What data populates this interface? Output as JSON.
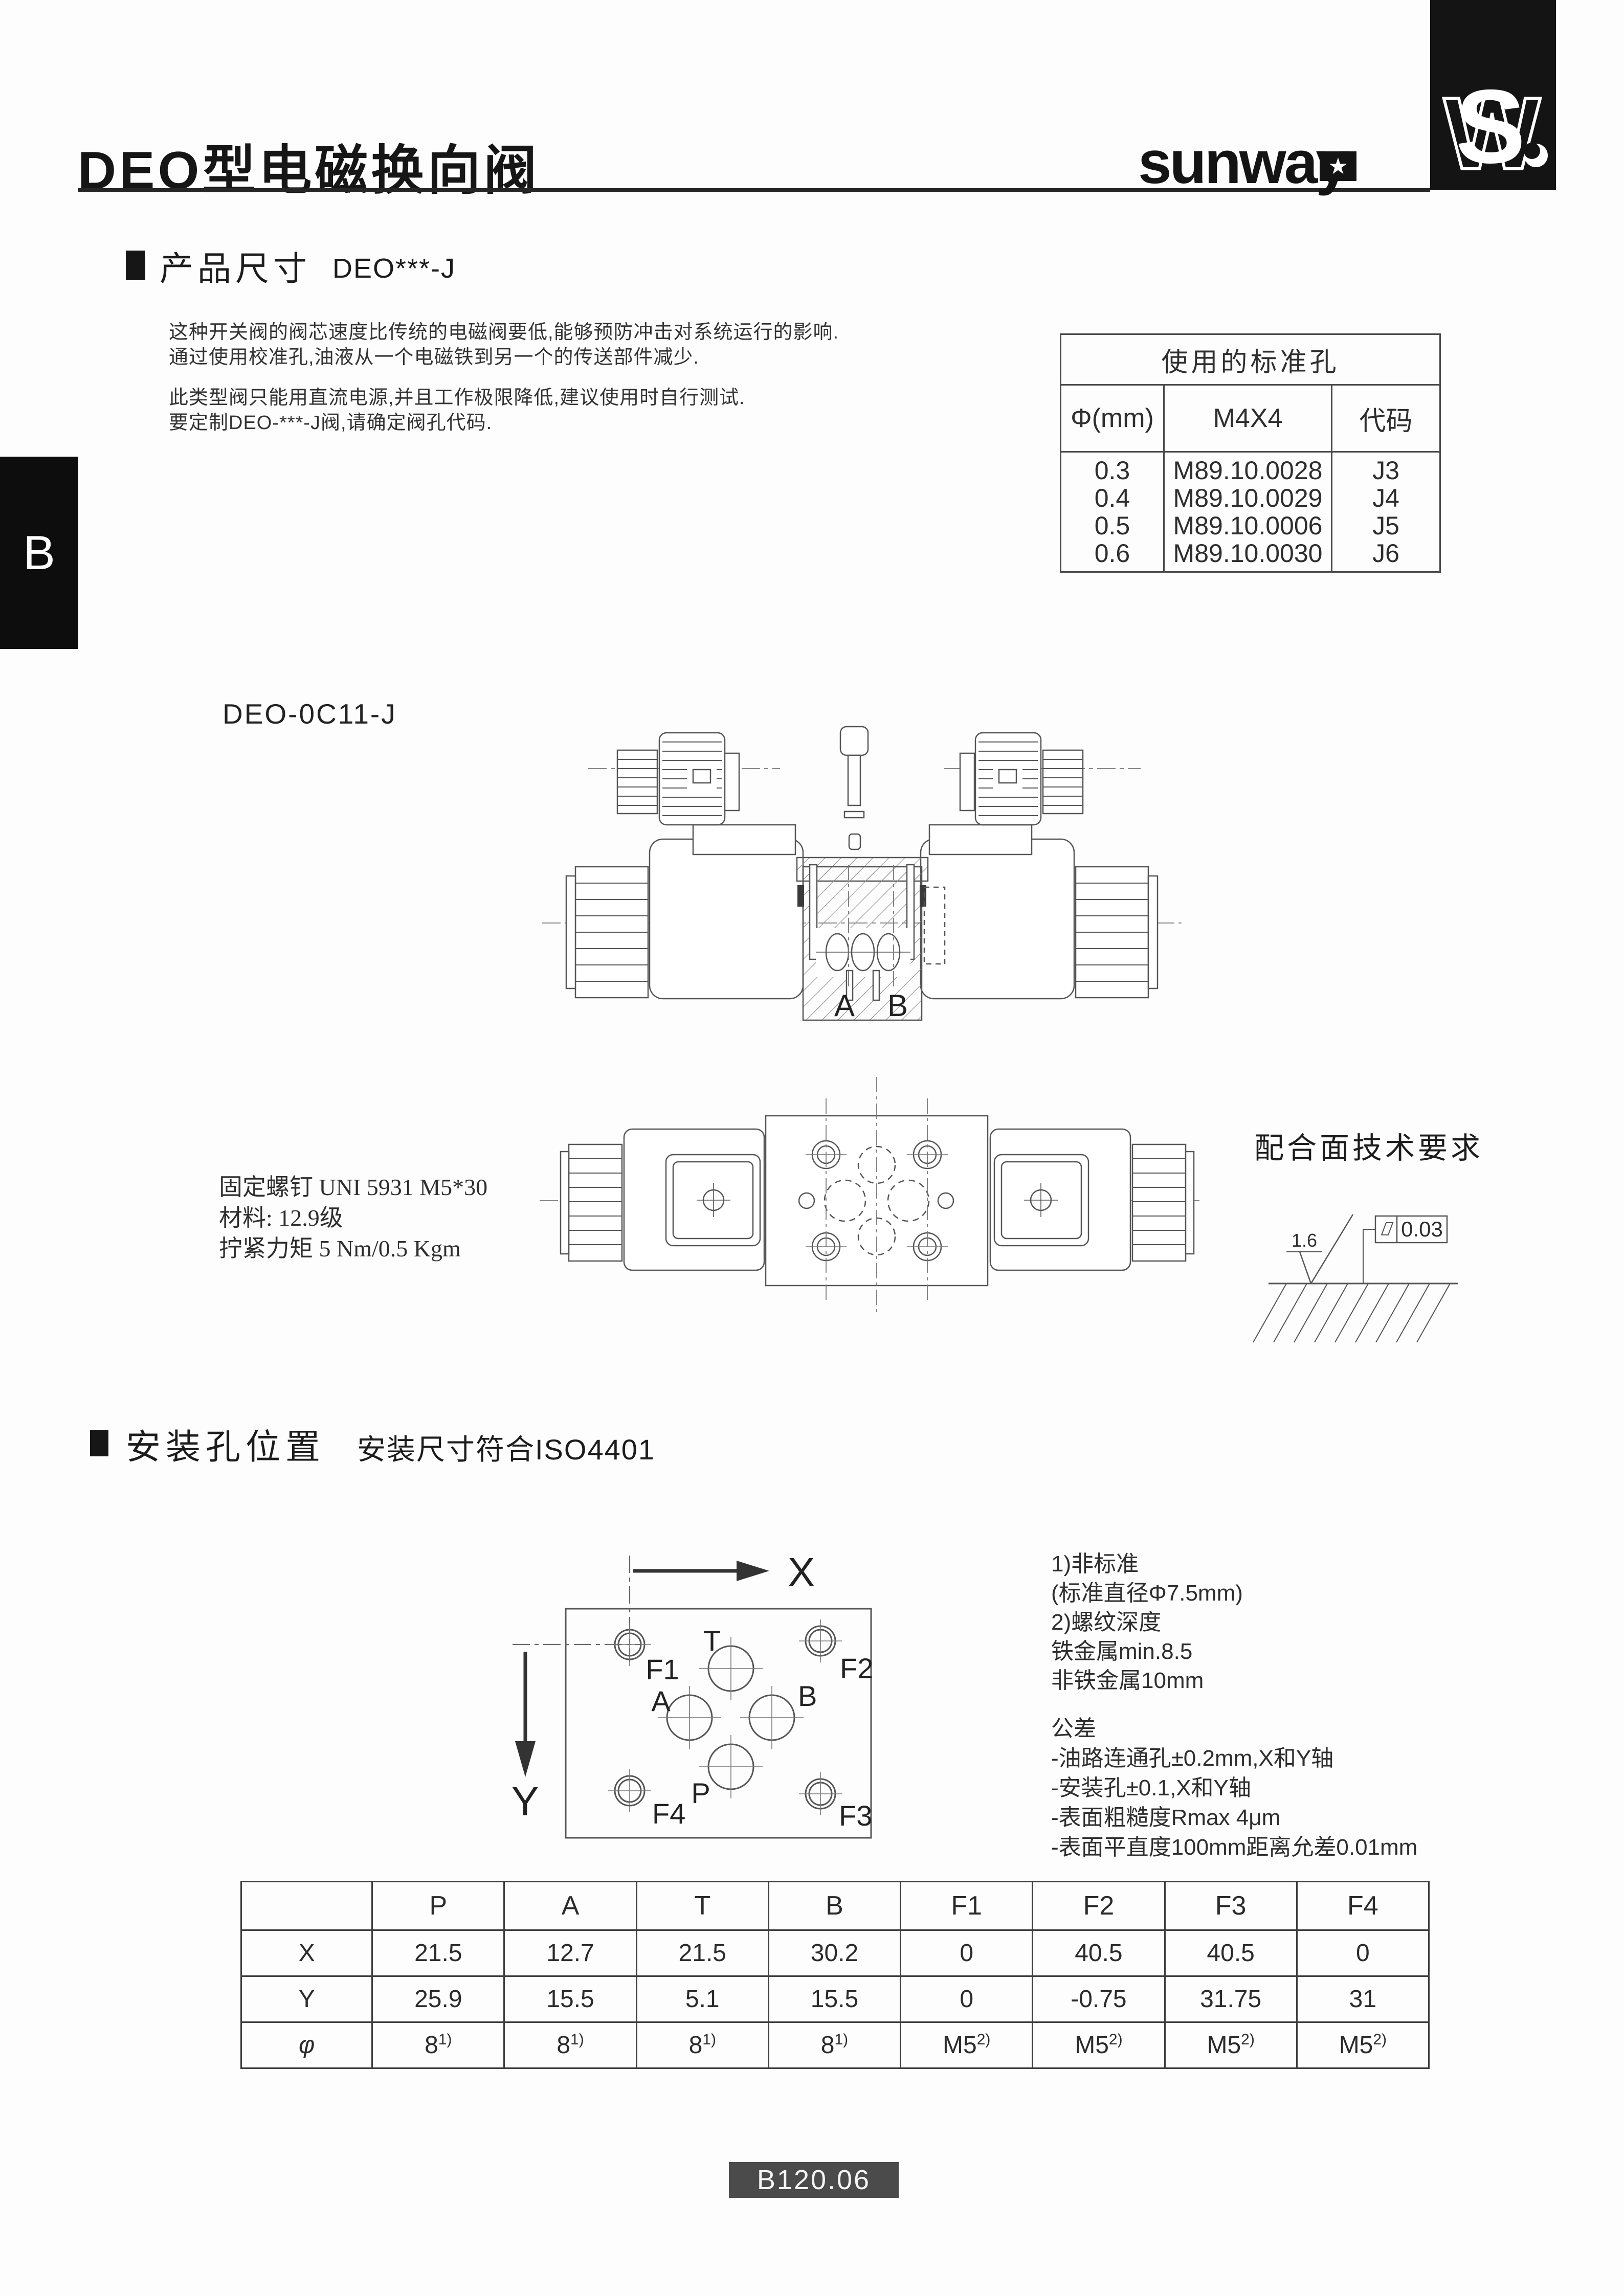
{
  "page": {
    "side_tab": "B",
    "footer_code": "B120.06"
  },
  "header": {
    "title": "DEO型电磁换向阀",
    "brand": "sunway",
    "brand_star": "★"
  },
  "section_product": {
    "title": "产品尺寸",
    "subtitle": "DEO***-J",
    "para1_line1": "这种开关阀的阀芯速度比传统的电磁阀要低,能够预防冲击对系统运行的影响.",
    "para1_line2": "通过使用校准孔,油液从一个电磁铁到另一个的传送部件减少.",
    "para2_line1": "此类型阀只能用直流电源,并且工作极限降低,建议使用时自行测试.",
    "para2_line2": "要定制DEO-***-J阀,请确定阀孔代码."
  },
  "std_table": {
    "title": "使用的标准孔",
    "col_diameter": "Φ(mm)",
    "col_part": "M4X4",
    "col_code": "代码",
    "rows": [
      {
        "d": "0.3",
        "part": "M89.10.0028",
        "code": "J3"
      },
      {
        "d": "0.4",
        "part": "M89.10.0029",
        "code": "J4"
      },
      {
        "d": "0.5",
        "part": "M89.10.0006",
        "code": "J5"
      },
      {
        "d": "0.6",
        "part": "M89.10.0030",
        "code": "J6"
      }
    ]
  },
  "model_label": "DEO-0C11-J",
  "drawing1": {
    "port_a": "A",
    "port_b": "B"
  },
  "screw_note": {
    "line1": "固定螺钉 UNI 5931 M5*30",
    "line2": "材料: 12.9级",
    "line3": "拧紧力矩 5 Nm/0.5 Kgm"
  },
  "mating": {
    "title": "配合面技术要求",
    "roughness": "1.6",
    "flatness": "0.03",
    "flatness_icon": "parallelogram"
  },
  "section_mounting": {
    "title": "安装孔位置",
    "subtitle": "安装尺寸符合ISO4401"
  },
  "mount_diagram": {
    "axis_x": "X",
    "axis_y": "Y",
    "hole_t": "T",
    "hole_a": "A",
    "hole_b": "B",
    "hole_p": "P",
    "hole_f1": "F1",
    "hole_f2": "F2",
    "hole_f3": "F3",
    "hole_f4": "F4"
  },
  "notes": {
    "n1": "1)非标准",
    "n2": "(标准直径Φ7.5mm)",
    "n3": "2)螺纹深度",
    "n4": "铁金属min.8.5",
    "n5": "非铁金属10mm",
    "tol_title": "公差",
    "tol1": "-油路连通孔±0.2mm,X和Y轴",
    "tol2": "-安装孔±0.1,X和Y轴",
    "tol3": "-表面粗糙度Rmax 4μm",
    "tol4": "-表面平直度100mm距离允差0.01mm"
  },
  "pos_table": {
    "headers": [
      "P",
      "A",
      "T",
      "B",
      "F1",
      "F2",
      "F3",
      "F4"
    ],
    "row_x_label": "X",
    "row_y_label": "Y",
    "row_phi_label": "φ",
    "x": [
      "21.5",
      "12.7",
      "21.5",
      "30.2",
      "0",
      "40.5",
      "40.5",
      "0"
    ],
    "y": [
      "25.9",
      "15.5",
      "5.1",
      "15.5",
      "0",
      "-0.75",
      "31.75",
      "31"
    ],
    "phi_base": [
      "8",
      "8",
      "8",
      "8",
      "M5",
      "M5",
      "M5",
      "M5"
    ],
    "phi_sup": [
      "1)",
      "1)",
      "1)",
      "1)",
      "2)",
      "2)",
      "2)",
      "2)"
    ]
  }
}
